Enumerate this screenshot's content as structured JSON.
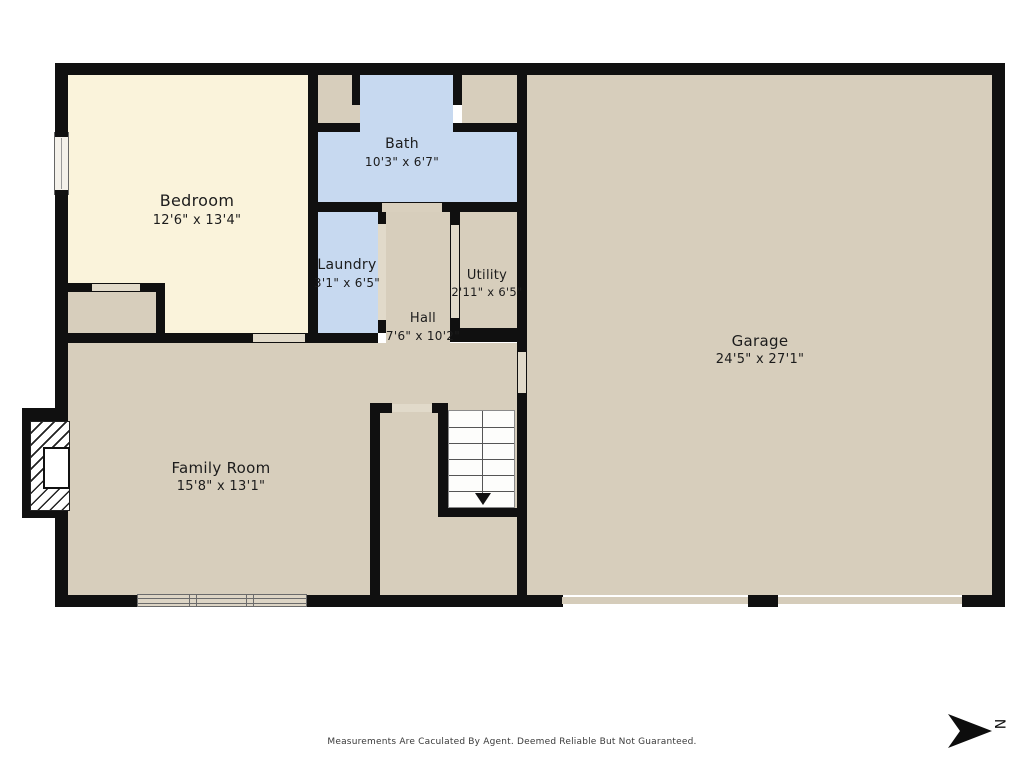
{
  "title": "First floor plan",
  "rooms": [
    {
      "name": "Bedroom",
      "dims": "12'6\" x 13'4\"",
      "fill": "#faf3db"
    },
    {
      "name": "Bath",
      "dims": "10'3\" x 6'7\"",
      "fill": "#c7d9f0"
    },
    {
      "name": "Laundry",
      "dims": "3'1\" x 6'5\"",
      "fill": "#c7d9f0"
    },
    {
      "name": "Utility",
      "dims": "2'11\" x 6'5\"",
      "fill": "#d7cebc"
    },
    {
      "name": "Hall",
      "dims": "7'6\" x 10'2\"",
      "fill": "#d7cebc"
    },
    {
      "name": "Family Room",
      "dims": "15'8\" x 13'1\"",
      "fill": "#d7cebc"
    },
    {
      "name": "Garage",
      "dims": "24'5\" x 27'1\"",
      "fill": "#d7cebc"
    }
  ],
  "compass": {
    "label": "N",
    "direction": "right"
  },
  "footer": {
    "disclaimer": "Measurements Are Caculated By Agent. Deemed Reliable But Not Guaranteed."
  },
  "colors": {
    "wall": "#101010",
    "floor_tan": "#d7cebc",
    "floor_cream": "#faf3db",
    "floor_blue": "#c7d9f0",
    "door_opening": "#e1daca",
    "background": "#ffffff"
  }
}
